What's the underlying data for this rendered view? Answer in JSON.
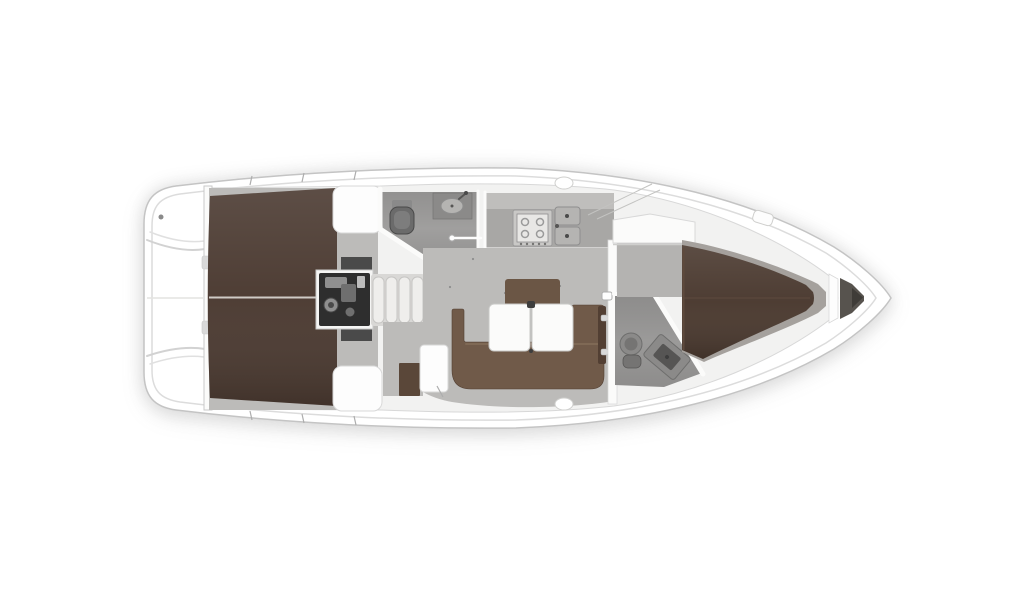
{
  "canvas": {
    "width": 1024,
    "height": 600,
    "background": "#ffffff"
  },
  "palette": {
    "hull_fill": "#ffffff",
    "hull_outline": "#c4c4c4",
    "rubrail_line": "#dcdcdc",
    "interior_base": "#f2f2f1",
    "trunk_line": "#d8d8d8",
    "wall_white": "#fbfbfa",
    "wall_line": "#c9c9c9",
    "floor_gray": "#bcbbb9",
    "floor_gray_fwd": "#b4b3b1",
    "floor_dot": "#8d8d8d",
    "head_floor": "#9a9998",
    "head_floor_fwd": "#959493",
    "berth_brown": "#4b3a31",
    "berth_brown_fwd": "#4a392f",
    "berth_base_gray": "#a5a19d",
    "berth_seam": "#5d4a3e",
    "berth_edge_light": "#5e4a3d",
    "settee_brown": "#705a49",
    "settee_highlight": "#7f6955",
    "settee_dark_edge": "#523f33",
    "backrest_brown": "#6b5645",
    "locker_brown": "#5a4739",
    "table_white": "#fbfbfa",
    "table_edge": "#c8c8c6",
    "hinge_dark": "#3d3d3d",
    "pad_white": "#fdfdfd",
    "pad_edge": "#d8d8d8",
    "hinge_metal": "#d9d9d9",
    "engine_well": "#4a4a4a",
    "engine_frame_white": "#f5f5f4",
    "engine_dark": "#2e2e2e",
    "engine_part_light": "#8f8f8f",
    "engine_part_mid": "#6f6f6f",
    "engine_part_bright": "#bdbdbd",
    "step_base": "#d9d8d6",
    "step_face": "#efeeec",
    "step_edge": "#c6c5c3",
    "counter_gray": "#a8a7a5",
    "counter_band": "#bfbebc",
    "stove_frame": "#c9c8c6",
    "stove_face": "#e8e7e5",
    "burner_line": "#9a9a9a",
    "sink_gray": "#b5b4b2",
    "sink_edge": "#8e8e8e",
    "drain_dark": "#4a4a4a",
    "fixture_gray": "#8b8a89",
    "fixture_mid": "#757473",
    "fixture_dark": "#565554",
    "fixture_outline": "#6e6e6d",
    "toilet_gray": "#6b6b6b",
    "toilet_lid": "#7d7d7d",
    "toilet_tank": "#8a8a8a",
    "anchor_dark": "#57534e",
    "anchor_wedge": "#3f3c38",
    "metal_dot": "#8a8a8a",
    "tick_line": "#adadad",
    "shroud_line": "#c3c3c1",
    "bench_line": "#d2d2d2",
    "bench_line_soft": "#e0e0e0",
    "centerline_light": "#e3e3e1",
    "berth_centerline": "#cfcbc6",
    "shadow_line": "#cfcfcd"
  }
}
